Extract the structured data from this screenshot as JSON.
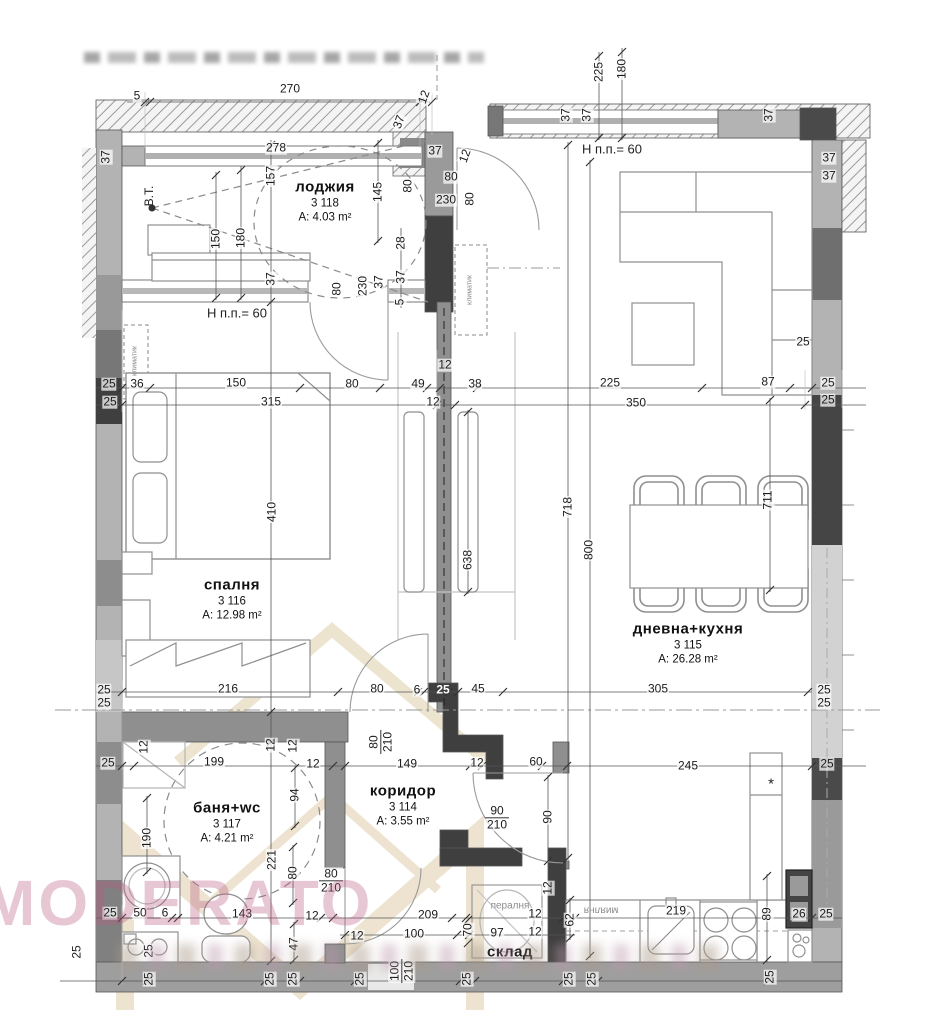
{
  "watermark": {
    "text": "MODERATO"
  },
  "rooms": [
    {
      "id": "logg",
      "name": "лоджия",
      "number": "3 118",
      "area": "A: 4.03 m²",
      "x": 325,
      "y": 201
    },
    {
      "id": "bedroom",
      "name": "спалня",
      "number": "3 116",
      "area": "A: 12.98 m²",
      "x": 232,
      "y": 599
    },
    {
      "id": "living",
      "name": "дневна+кухня",
      "number": "3 115",
      "area": "A: 26.28 m²",
      "x": 688,
      "y": 643
    },
    {
      "id": "bath",
      "name": "баня+wc",
      "number": "3 117",
      "area": "A: 4.21 m²",
      "x": 227,
      "y": 822
    },
    {
      "id": "hall",
      "name": "коридор",
      "number": "3 114",
      "area": "A: 3.55 m²",
      "x": 403,
      "y": 805
    },
    {
      "id": "storage",
      "name": "склад",
      "number": "",
      "area": "",
      "x": 510,
      "y": 952
    }
  ],
  "annotations": [
    {
      "text": "Н п.п.= 60",
      "x": 237,
      "y": 313,
      "size": 13
    },
    {
      "text": "Н п.п.= 60",
      "x": 612,
      "y": 149,
      "size": 13
    },
    {
      "text": "В.Т.",
      "x": 149,
      "y": 196,
      "size": 12,
      "rot": -90
    },
    {
      "text": "климатик",
      "x": 470,
      "y": 290,
      "size": 7,
      "rot": -90,
      "muted": true
    },
    {
      "text": "климатик",
      "x": 135,
      "y": 361,
      "size": 7,
      "rot": -90,
      "muted": true
    },
    {
      "text": "пералня",
      "x": 510,
      "y": 906,
      "size": 10,
      "muted": true
    },
    {
      "text": "миялня",
      "x": 601,
      "y": 910,
      "size": 10,
      "rot": 180,
      "muted": true
    },
    {
      "text": "*",
      "x": 771,
      "y": 784,
      "size": 15
    }
  ],
  "door_sizes": [
    {
      "top": "90",
      "bottom": "210",
      "x": 497,
      "y": 818,
      "vert": false
    },
    {
      "top": "80",
      "bottom": "210",
      "x": 331,
      "y": 881,
      "vert": false
    },
    {
      "top": "80",
      "bottom": "210",
      "x": 381,
      "y": 742,
      "vert": true
    },
    {
      "top": "100",
      "bottom": "210",
      "x": 402,
      "y": 971,
      "vert": true
    }
  ],
  "dimensions": [
    {
      "t": "5",
      "x": 137,
      "y": 96
    },
    {
      "t": "270",
      "x": 290,
      "y": 89
    },
    {
      "t": "12",
      "x": 424,
      "y": 97,
      "r": -70
    },
    {
      "t": "225",
      "x": 599,
      "y": 72,
      "r": -90
    },
    {
      "t": "180",
      "x": 622,
      "y": 69,
      "r": -90
    },
    {
      "t": "37",
      "x": 106,
      "y": 157,
      "r": -90
    },
    {
      "t": "157",
      "x": 271,
      "y": 176,
      "r": -90
    },
    {
      "t": "278",
      "x": 276,
      "y": 148
    },
    {
      "t": "37",
      "x": 399,
      "y": 122,
      "r": -70
    },
    {
      "t": "37",
      "x": 435,
      "y": 151
    },
    {
      "t": "12",
      "x": 465,
      "y": 156,
      "r": -70
    },
    {
      "t": "80",
      "x": 451,
      "y": 177
    },
    {
      "t": "80",
      "x": 408,
      "y": 186,
      "r": -90
    },
    {
      "t": "230",
      "x": 446,
      "y": 200
    },
    {
      "t": "80",
      "x": 470,
      "y": 199,
      "r": -90
    },
    {
      "t": "28",
      "x": 401,
      "y": 243,
      "r": -90
    },
    {
      "t": "37",
      "x": 401,
      "y": 277,
      "r": -90
    },
    {
      "t": "5",
      "x": 400,
      "y": 302,
      "r": -90
    },
    {
      "t": "145",
      "x": 378,
      "y": 192,
      "r": -90
    },
    {
      "t": "150",
      "x": 216,
      "y": 239,
      "r": -90
    },
    {
      "t": "180",
      "x": 241,
      "y": 238,
      "r": -90
    },
    {
      "t": "37",
      "x": 271,
      "y": 279,
      "r": -90
    },
    {
      "t": "80",
      "x": 337,
      "y": 289,
      "r": -90
    },
    {
      "t": "230",
      "x": 363,
      "y": 286,
      "r": -90
    },
    {
      "t": "37",
      "x": 379,
      "y": 282,
      "r": -90
    },
    {
      "t": "37",
      "x": 566,
      "y": 115,
      "r": -90
    },
    {
      "t": "37",
      "x": 587,
      "y": 115,
      "r": -90
    },
    {
      "t": "37",
      "x": 769,
      "y": 115,
      "r": -90
    },
    {
      "t": "37",
      "x": 829,
      "y": 158
    },
    {
      "t": "37",
      "x": 829,
      "y": 176
    },
    {
      "t": "12",
      "x": 445,
      "y": 365
    },
    {
      "t": "25",
      "x": 109,
      "y": 384
    },
    {
      "t": "25",
      "x": 110,
      "y": 402
    },
    {
      "t": "36",
      "x": 137,
      "y": 384
    },
    {
      "t": "150",
      "x": 236,
      "y": 383
    },
    {
      "t": "80",
      "x": 352,
      "y": 384
    },
    {
      "t": "49",
      "x": 418,
      "y": 384
    },
    {
      "t": "38",
      "x": 475,
      "y": 384
    },
    {
      "t": "315",
      "x": 271,
      "y": 402
    },
    {
      "t": "12",
      "x": 433,
      "y": 402
    },
    {
      "t": "225",
      "x": 610,
      "y": 383
    },
    {
      "t": "87",
      "x": 768,
      "y": 382
    },
    {
      "t": "350",
      "x": 636,
      "y": 403
    },
    {
      "t": "25",
      "x": 803,
      "y": 342
    },
    {
      "t": "25",
      "x": 828,
      "y": 383
    },
    {
      "t": "25",
      "x": 828,
      "y": 400
    },
    {
      "t": "410",
      "x": 272,
      "y": 512,
      "r": -90
    },
    {
      "t": "638",
      "x": 468,
      "y": 560,
      "r": -90
    },
    {
      "t": "718",
      "x": 568,
      "y": 507,
      "r": -90
    },
    {
      "t": "800",
      "x": 589,
      "y": 550,
      "r": -90
    },
    {
      "t": "711",
      "x": 768,
      "y": 500,
      "r": -90
    },
    {
      "t": "216",
      "x": 228,
      "y": 689
    },
    {
      "t": "80",
      "x": 377,
      "y": 689
    },
    {
      "t": "6",
      "x": 417,
      "y": 690
    },
    {
      "t": "25",
      "x": 443,
      "y": 690,
      "inv": true
    },
    {
      "t": "45",
      "x": 478,
      "y": 689
    },
    {
      "t": "305",
      "x": 658,
      "y": 689
    },
    {
      "t": "25",
      "x": 104,
      "y": 690
    },
    {
      "t": "25",
      "x": 104,
      "y": 703
    },
    {
      "t": "25",
      "x": 824,
      "y": 690
    },
    {
      "t": "25",
      "x": 824,
      "y": 703
    },
    {
      "t": "12",
      "x": 144,
      "y": 747,
      "r": -90
    },
    {
      "t": "199",
      "x": 214,
      "y": 762
    },
    {
      "t": "12",
      "x": 271,
      "y": 745,
      "r": -90
    },
    {
      "t": "12",
      "x": 293,
      "y": 746,
      "r": -90
    },
    {
      "t": "12",
      "x": 313,
      "y": 764
    },
    {
      "t": "149",
      "x": 407,
      "y": 764
    },
    {
      "t": "12",
      "x": 477,
      "y": 763
    },
    {
      "t": "60",
      "x": 536,
      "y": 762
    },
    {
      "t": "245",
      "x": 688,
      "y": 766
    },
    {
      "t": "25",
      "x": 827,
      "y": 764
    },
    {
      "t": "25",
      "x": 108,
      "y": 763
    },
    {
      "t": "94",
      "x": 295,
      "y": 795,
      "r": -90
    },
    {
      "t": "190",
      "x": 147,
      "y": 838,
      "r": -90
    },
    {
      "t": "221",
      "x": 272,
      "y": 860,
      "r": -90
    },
    {
      "t": "80",
      "x": 293,
      "y": 873,
      "r": -90
    },
    {
      "t": "90",
      "x": 548,
      "y": 817,
      "r": -90
    },
    {
      "t": "25",
      "x": 110,
      "y": 913
    },
    {
      "t": "50",
      "x": 140,
      "y": 913
    },
    {
      "t": "6",
      "x": 165,
      "y": 913
    },
    {
      "t": "143",
      "x": 242,
      "y": 914
    },
    {
      "t": "12",
      "x": 312,
      "y": 916
    },
    {
      "t": "47",
      "x": 294,
      "y": 944,
      "r": -90
    },
    {
      "t": "12",
      "x": 357,
      "y": 936
    },
    {
      "t": "209",
      "x": 428,
      "y": 915
    },
    {
      "t": "100",
      "x": 414,
      "y": 934
    },
    {
      "t": "70",
      "x": 468,
      "y": 930,
      "r": -90
    },
    {
      "t": "97",
      "x": 497,
      "y": 933
    },
    {
      "t": "12",
      "x": 535,
      "y": 914
    },
    {
      "t": "12",
      "x": 535,
      "y": 932
    },
    {
      "t": "12",
      "x": 548,
      "y": 888,
      "r": -90
    },
    {
      "t": "62",
      "x": 570,
      "y": 920,
      "r": -90
    },
    {
      "t": "219",
      "x": 676,
      "y": 911
    },
    {
      "t": "89",
      "x": 767,
      "y": 914,
      "r": -90
    },
    {
      "t": "26",
      "x": 799,
      "y": 914
    },
    {
      "t": "25",
      "x": 826,
      "y": 914
    },
    {
      "t": "25",
      "x": 77,
      "y": 952,
      "r": -90
    },
    {
      "t": "25",
      "x": 149,
      "y": 951,
      "r": -90
    },
    {
      "t": "25",
      "x": 149,
      "y": 979,
      "r": -90
    },
    {
      "t": "25",
      "x": 270,
      "y": 979,
      "r": -90
    },
    {
      "t": "25",
      "x": 293,
      "y": 979,
      "r": -90
    },
    {
      "t": "25",
      "x": 360,
      "y": 979,
      "r": -90
    },
    {
      "t": "25",
      "x": 467,
      "y": 979,
      "r": -90
    },
    {
      "t": "25",
      "x": 569,
      "y": 979,
      "r": -90
    },
    {
      "t": "25",
      "x": 592,
      "y": 979,
      "r": -90
    },
    {
      "t": "25",
      "x": 770,
      "y": 977,
      "r": -90
    }
  ]
}
